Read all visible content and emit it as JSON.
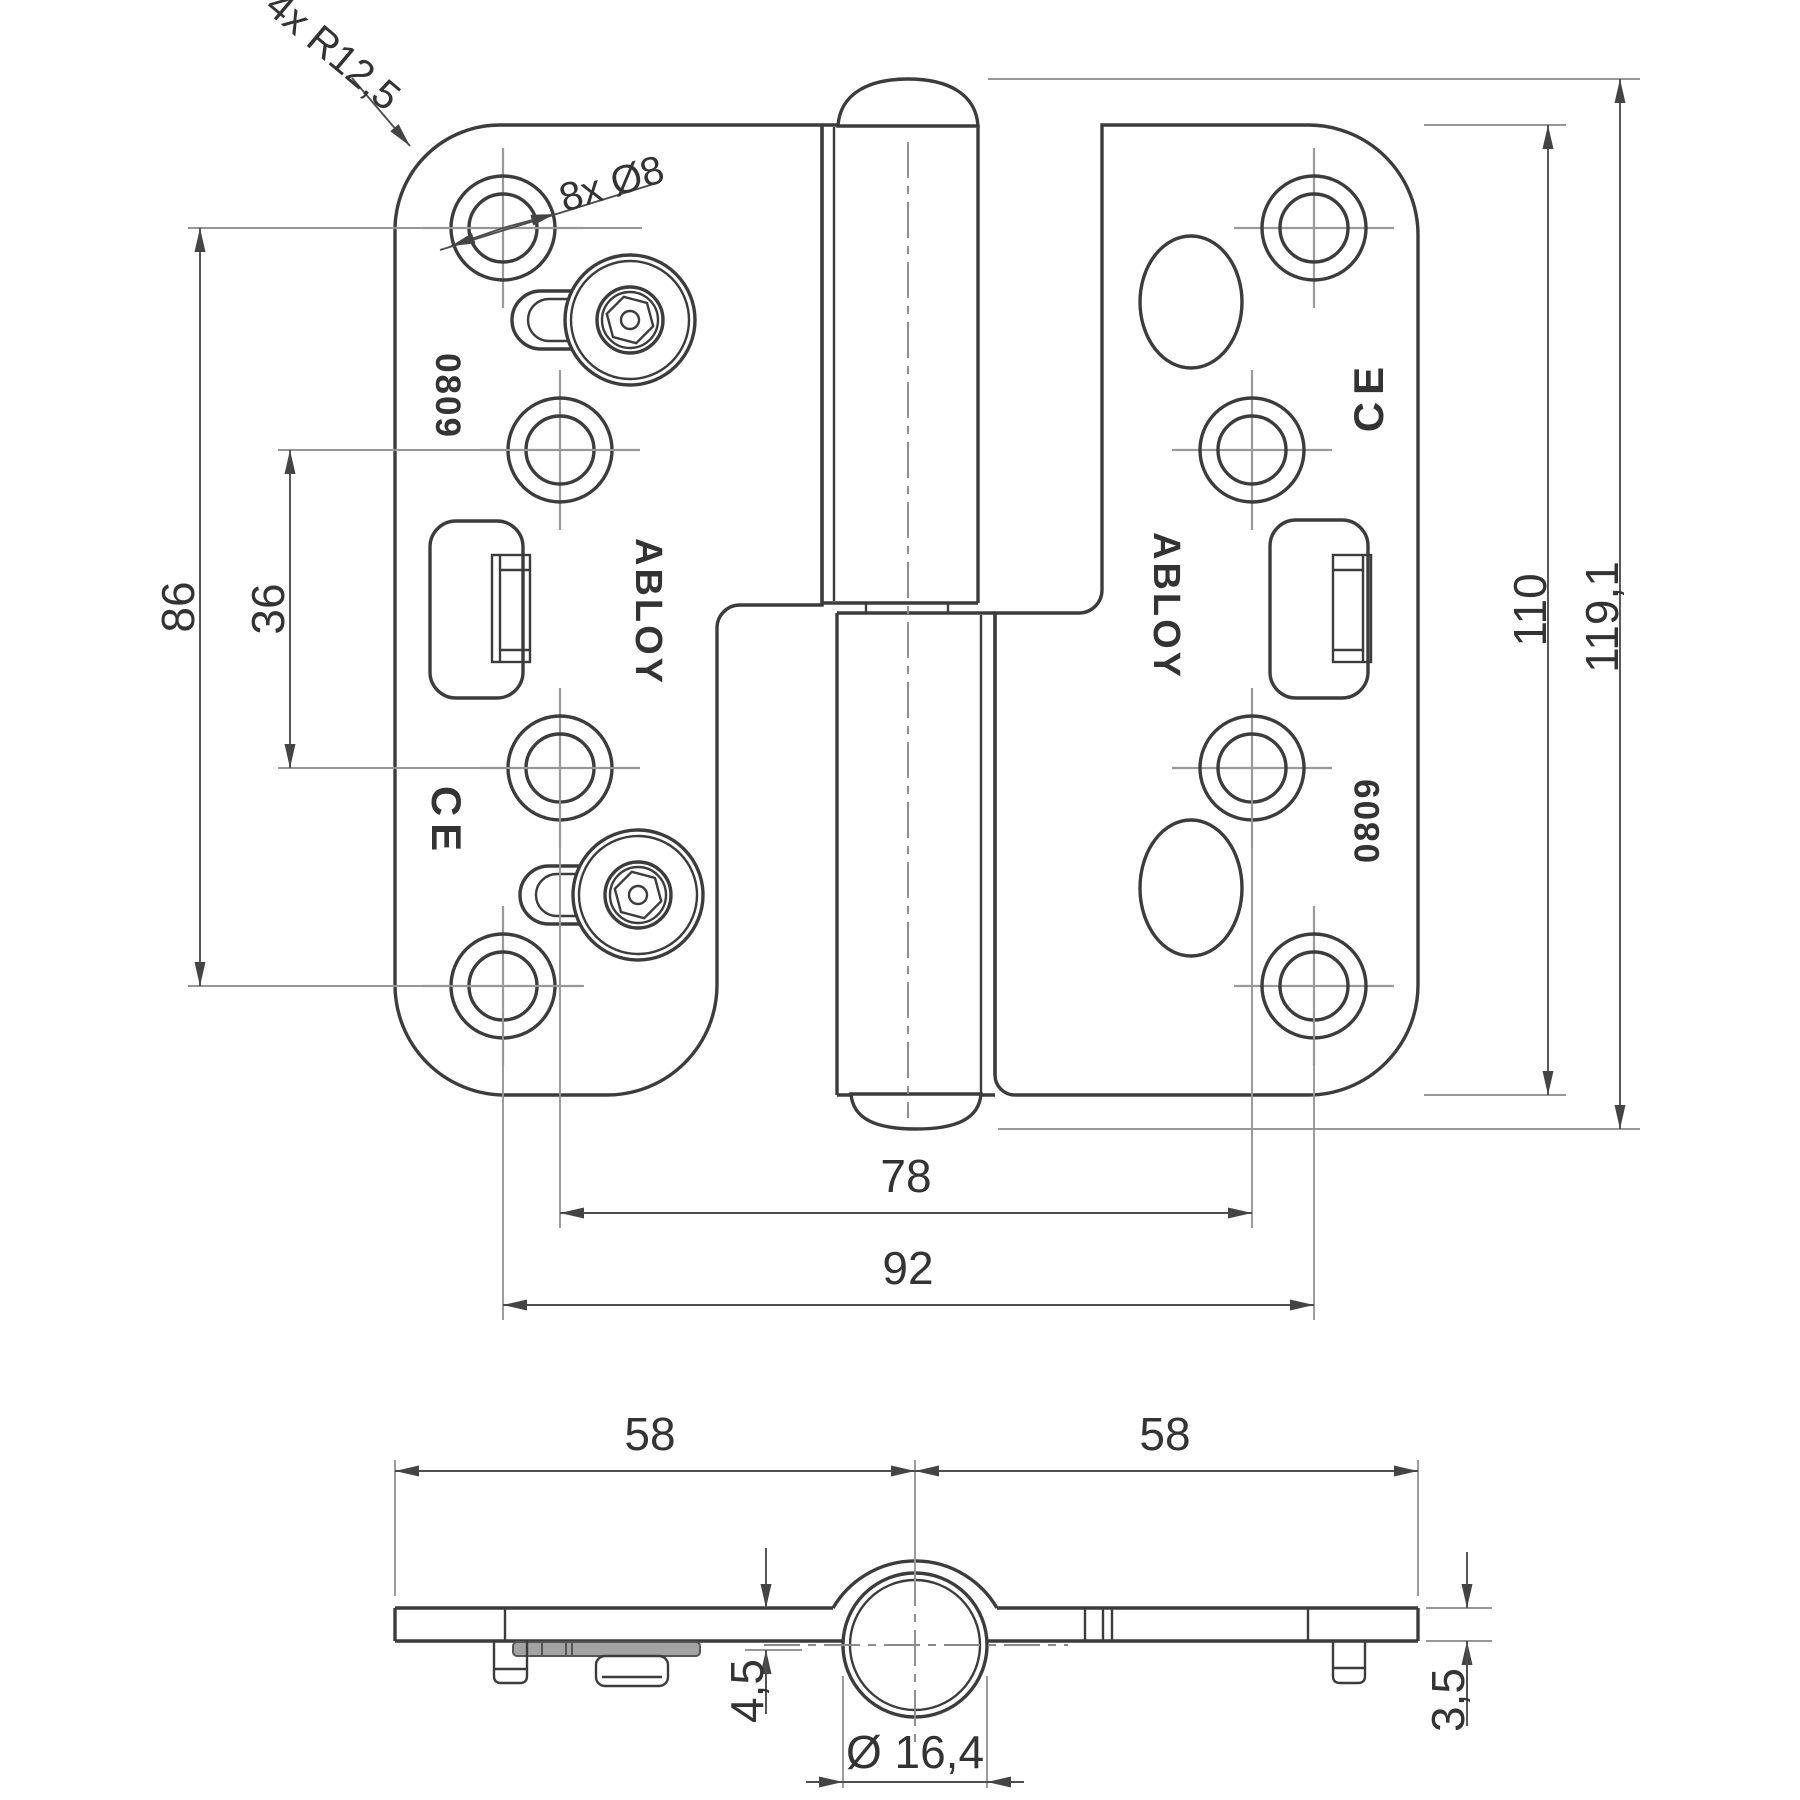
{
  "front_view": {
    "brand_left": "ABLOY",
    "brand_right": "ABLOY",
    "model_left": "0809",
    "model_right": "0809",
    "ce_left": "CE",
    "ce_right": "CE",
    "corner_radius_label": "4x R12,5",
    "hole_diameter_label": "8x Ø8",
    "dim_outer_hole_spacing_v": "86",
    "dim_inner_hole_spacing_v": "36",
    "dim_plate_height": "110",
    "dim_total_height": "119,1",
    "dim_inner_hole_spacing_h": "78",
    "dim_outer_hole_spacing_h": "92"
  },
  "top_view": {
    "dim_leaf_left": "58",
    "dim_leaf_right": "58",
    "dim_underside_depth": "4,5",
    "dim_plate_thickness": "3,5",
    "dim_knuckle_diameter": "Ø 16,4"
  }
}
